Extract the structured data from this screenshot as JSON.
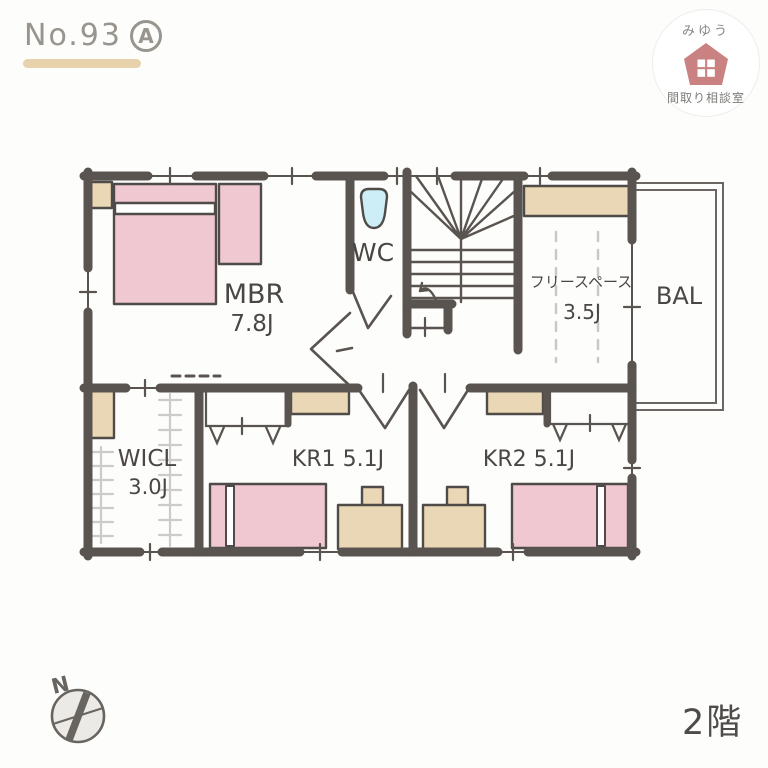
{
  "header": {
    "plan_number": "No.93",
    "plan_variant": "A"
  },
  "logo": {
    "top": "みゆう",
    "bottom": "間取り相談室",
    "icon": "house-icon"
  },
  "floor_label": "2階",
  "compass": {
    "north": "N",
    "icon": "compass-rose-icon"
  },
  "rooms": {
    "mbr": {
      "name": "MBR",
      "size": "7.8J"
    },
    "wc": {
      "name": "WC",
      "icon": "toilet-icon"
    },
    "free_space": {
      "name": "フリースペース",
      "size": "3.5J"
    },
    "balcony": {
      "name": "BAL"
    },
    "wicl": {
      "name": "WICL",
      "size": "3.0J"
    },
    "kr1": {
      "name": "KR1 5.1J"
    },
    "kr2": {
      "name": "KR2 5.1J"
    }
  },
  "colors": {
    "bg": "#fdfdfc",
    "wall": "#595450",
    "ink": "#4a4643",
    "muted": "#98948e",
    "pink": "#f0c8d2",
    "beige": "#ead7b5",
    "toilet": "#cdeef7",
    "rose": "#c98181",
    "underline": "#e8d2ab",
    "hanger": "#cccbc9",
    "dash": "#c9c9c9"
  }
}
